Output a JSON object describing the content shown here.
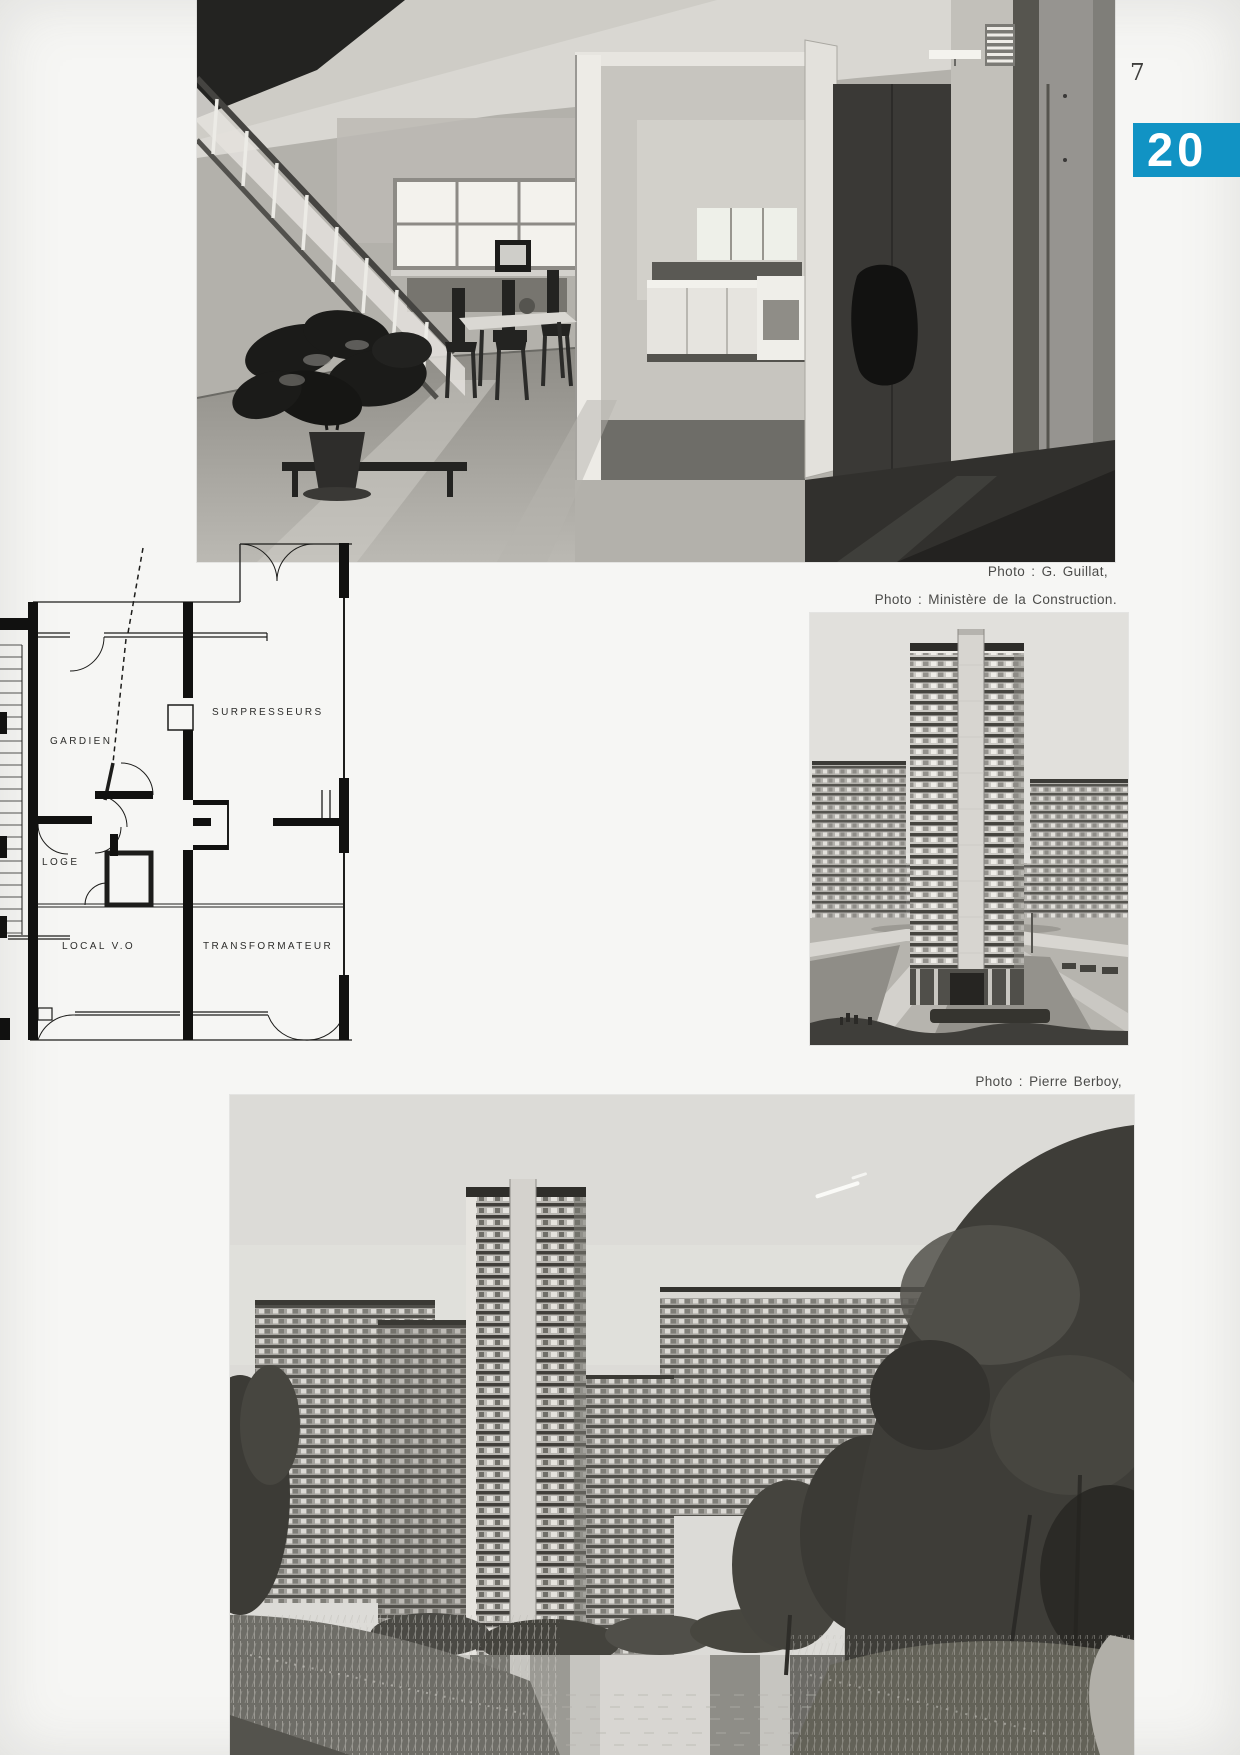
{
  "page": {
    "number": "7",
    "badge": {
      "text": "20",
      "color": "#1193c4"
    }
  },
  "photos": {
    "interior": {
      "credit": "Photo : G. Guillat,"
    },
    "tower": {
      "credit": "Photo : Ministère de la Construction."
    },
    "canal": {
      "credit": "Photo : Pierre Berboy,"
    }
  },
  "floor_plan": {
    "labels": {
      "surpresseurs": "SURPRESSEURS",
      "gardien": "GARDIEN",
      "loge": "LOGE",
      "local_vo": "LOCAL V.O",
      "transformateur": "TRANSFORMATEUR"
    }
  }
}
